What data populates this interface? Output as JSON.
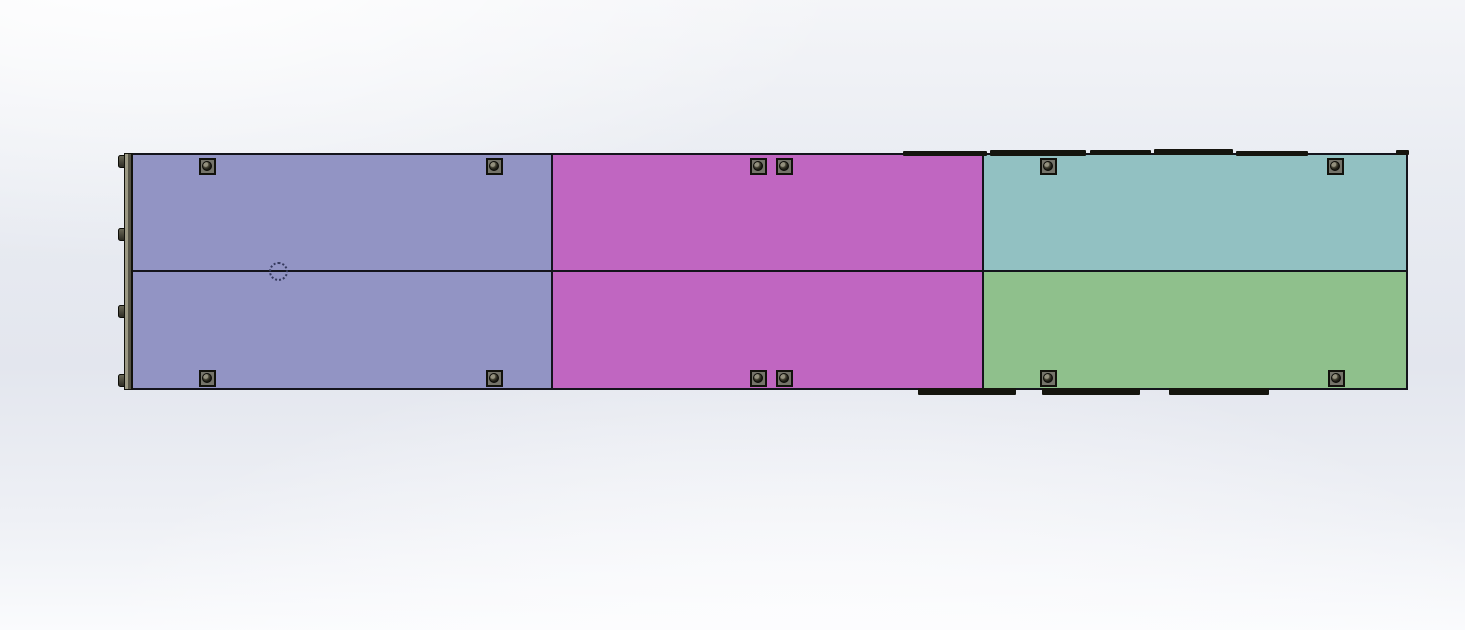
{
  "viewport": {
    "app_context": "3D CAD shaded viewport, no UI chrome visible",
    "background_top": "#ffffff",
    "background_mid": "#e4e7ef",
    "background_bottom": "#fafbfd",
    "outline_color": "#14141c"
  },
  "assembly": {
    "description": "Long rectangular six-panel enclosure assembly viewed flat-on: two rows by three columns of colored panels with corner fastening screws, a mounting rail on the left edge and dark gasket strips on the right top and bottom edges",
    "panels": [
      {
        "id": "top-left",
        "color": "#9294c4"
      },
      {
        "id": "top-middle",
        "color": "#c066c1"
      },
      {
        "id": "top-right",
        "color": "#92c1c2"
      },
      {
        "id": "bottom-left",
        "color": "#9294c4"
      },
      {
        "id": "bottom-middle",
        "color": "#c066c1"
      },
      {
        "id": "bottom-right",
        "color": "#8fc08c"
      }
    ],
    "fasteners": {
      "type": "socket-head screw on square pad",
      "pad_color": "#75746a",
      "head_color": "#1c1b14",
      "count": 12,
      "positions": [
        [
          207,
          166
        ],
        [
          494,
          166
        ],
        [
          758,
          166
        ],
        [
          784,
          166
        ],
        [
          1048,
          166
        ],
        [
          1335,
          166
        ],
        [
          207,
          378
        ],
        [
          494,
          378
        ],
        [
          758,
          378
        ],
        [
          784,
          378
        ],
        [
          1048,
          378
        ],
        [
          1336,
          378
        ]
      ]
    },
    "left_rail": {
      "x": 124,
      "y": 153,
      "width": 9,
      "height": 237,
      "color": "#9b9883",
      "tab_color": "#4a4939",
      "tabs_y": [
        155,
        228,
        305,
        374
      ]
    },
    "top_edge_strips": [
      [
        903,
        151,
        84,
        5
      ],
      [
        990,
        150,
        96,
        6
      ],
      [
        1090,
        150,
        61,
        5
      ],
      [
        1154,
        149,
        79,
        6
      ],
      [
        1236,
        151,
        72,
        5
      ]
    ],
    "bottom_edge_strips": [
      [
        918,
        388,
        98,
        7
      ],
      [
        1042,
        388,
        98,
        7
      ],
      [
        1169,
        388,
        100,
        7
      ]
    ],
    "top_right_step": [
      1396,
      150,
      13,
      5
    ],
    "hidden_line_circle": {
      "cx": 278,
      "cy": 271,
      "diameter": 19,
      "color": "#363a5e"
    }
  }
}
